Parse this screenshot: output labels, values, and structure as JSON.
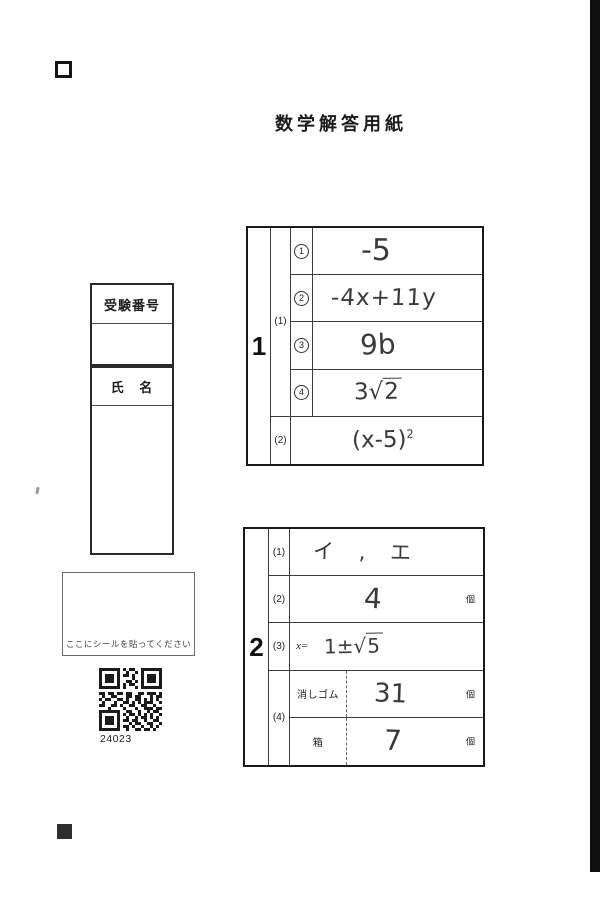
{
  "title": "数学解答用紙",
  "id_box": {
    "exam_number_label": "受験番号",
    "name_label": "氏 名"
  },
  "seal_box": {
    "text": "ここにシールを貼ってください"
  },
  "qr": {
    "label": "24023",
    "icon": "qr-code"
  },
  "marks": {
    "top_left": "hollow-square-registration-mark",
    "bottom_left": "filled-square-registration-mark",
    "right_edge": "black-scan-edge-bar"
  },
  "table1": {
    "number": "1",
    "group1_label": "(1)",
    "items": [
      {
        "num": "1",
        "answer": "-5"
      },
      {
        "num": "2",
        "answer": "-4x+11y"
      },
      {
        "num": "3",
        "answer": "9b"
      },
      {
        "num": "4",
        "coeff": "3",
        "radical_sign": "√",
        "radicand": "2"
      }
    ],
    "row2_label": "(2)",
    "row2_base": "(x-5)",
    "row2_exponent": "2"
  },
  "table2": {
    "number": "2",
    "rows": [
      {
        "label": "(1)",
        "answer": "イ , エ"
      },
      {
        "label": "(2)",
        "answer": "4",
        "unit": "個"
      },
      {
        "label": "(3)",
        "prefix": "x=",
        "lead": "1±",
        "radical_sign": "√",
        "radicand": "5"
      },
      {
        "label": "(4)",
        "sub": [
          {
            "item": "消しゴム",
            "answer": "31",
            "unit": "個"
          },
          {
            "item": "箱",
            "answer": "7",
            "unit": "個"
          }
        ]
      }
    ]
  }
}
